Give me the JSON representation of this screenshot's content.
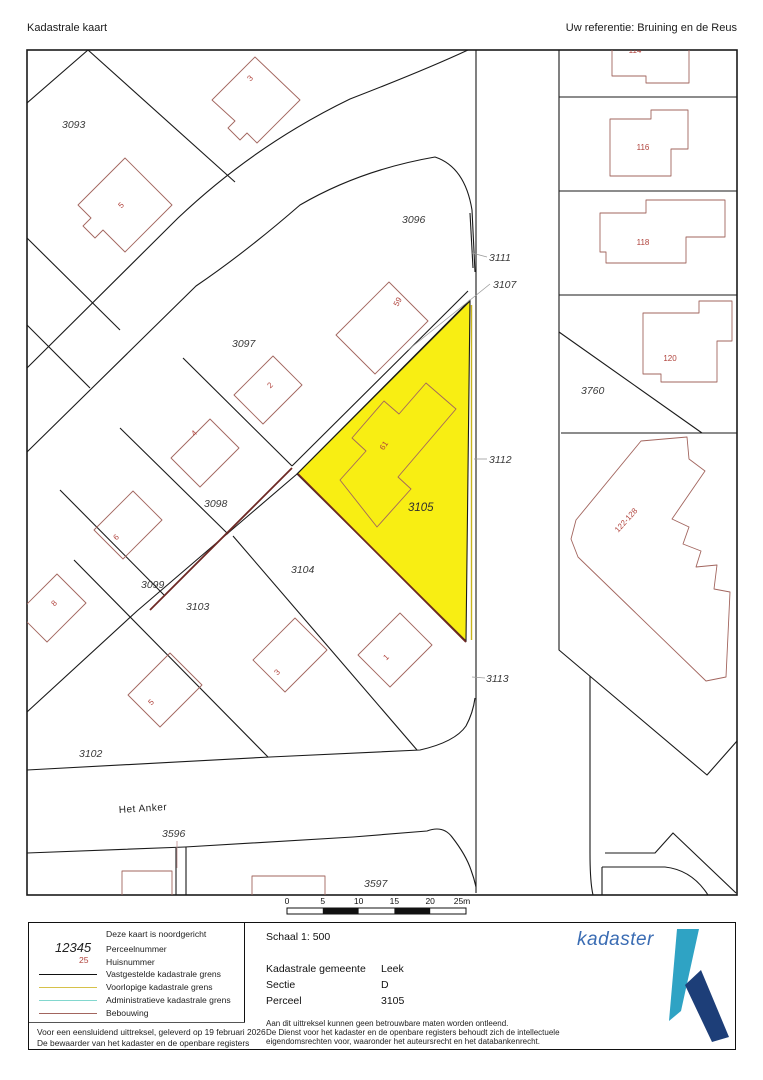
{
  "header": {
    "title": "Kadastrale kaart",
    "reference": "Uw referentie: Bruining en de Reus"
  },
  "map": {
    "highlight_color": "#f8ee13",
    "boundary_color": "#1a1a1a",
    "building_color": "#a2655e",
    "street_label": "Het Anker",
    "parcel_labels": [
      {
        "text": "3093"
      },
      {
        "text": "3096"
      },
      {
        "text": "3097"
      },
      {
        "text": "3098"
      },
      {
        "text": "3099"
      },
      {
        "text": "3103"
      },
      {
        "text": "3102"
      },
      {
        "text": "3104"
      },
      {
        "text": "3105"
      },
      {
        "text": "3760"
      },
      {
        "text": "3596"
      },
      {
        "text": "3597"
      }
    ],
    "leader_labels": [
      {
        "text": "3111"
      },
      {
        "text": "3107"
      },
      {
        "text": "3112"
      },
      {
        "text": "3113"
      }
    ],
    "house_numbers": [
      {
        "text": "5"
      },
      {
        "text": "3"
      },
      {
        "text": "2"
      },
      {
        "text": "4"
      },
      {
        "text": "6"
      },
      {
        "text": "8"
      },
      {
        "text": "59"
      },
      {
        "text": "61"
      },
      {
        "text": "1"
      },
      {
        "text": "3"
      },
      {
        "text": "5"
      },
      {
        "text": "114"
      },
      {
        "text": "116"
      },
      {
        "text": "118"
      },
      {
        "text": "120"
      },
      {
        "text": "122-128"
      }
    ],
    "scale_bar": {
      "ticks": [
        "0",
        "5",
        "10",
        "15",
        "20",
        "25m"
      ]
    }
  },
  "legend": {
    "north_note": "Deze kaart is noordgericht",
    "rows": [
      {
        "sample": "12345",
        "label": "Perceelnummer"
      },
      {
        "sample": "25",
        "label": "Huisnummer"
      },
      {
        "label": "Vastgestelde kadastrale grens",
        "color": "#111111"
      },
      {
        "label": "Voorlopige kadastrale grens",
        "color": "#d6c14a"
      },
      {
        "label": "Administratieve kadastrale grens",
        "color": "#82d7ce"
      },
      {
        "label": "Bebouwing",
        "color": "#a2655e"
      }
    ],
    "footer_line1": "Voor een eensluidend uittreksel, geleverd op 19 februari 2026",
    "footer_line2": "De bewaarder van het kadaster en de openbare registers"
  },
  "info": {
    "schaal": "Schaal 1: 500",
    "rows": [
      {
        "label": "Kadastrale gemeente",
        "value": "Leek"
      },
      {
        "label": "Sectie",
        "value": "D"
      },
      {
        "label": "Perceel",
        "value": "3105"
      }
    ],
    "disclaimer1": "Aan dit uittreksel kunnen geen betrouwbare maten worden ontleend.",
    "disclaimer2": "De Dienst voor het kadaster en de openbare registers behoudt zich de intellectuele",
    "disclaimer3": "eigendomsrechten voor, waaronder het auteursrecht en het databankenrecht."
  },
  "logo": {
    "wordmark": "kadaster",
    "wordmark_color": "#3a6cb3",
    "mark_light_color": "#2fa3c4",
    "mark_dark_color": "#1d3e78"
  }
}
